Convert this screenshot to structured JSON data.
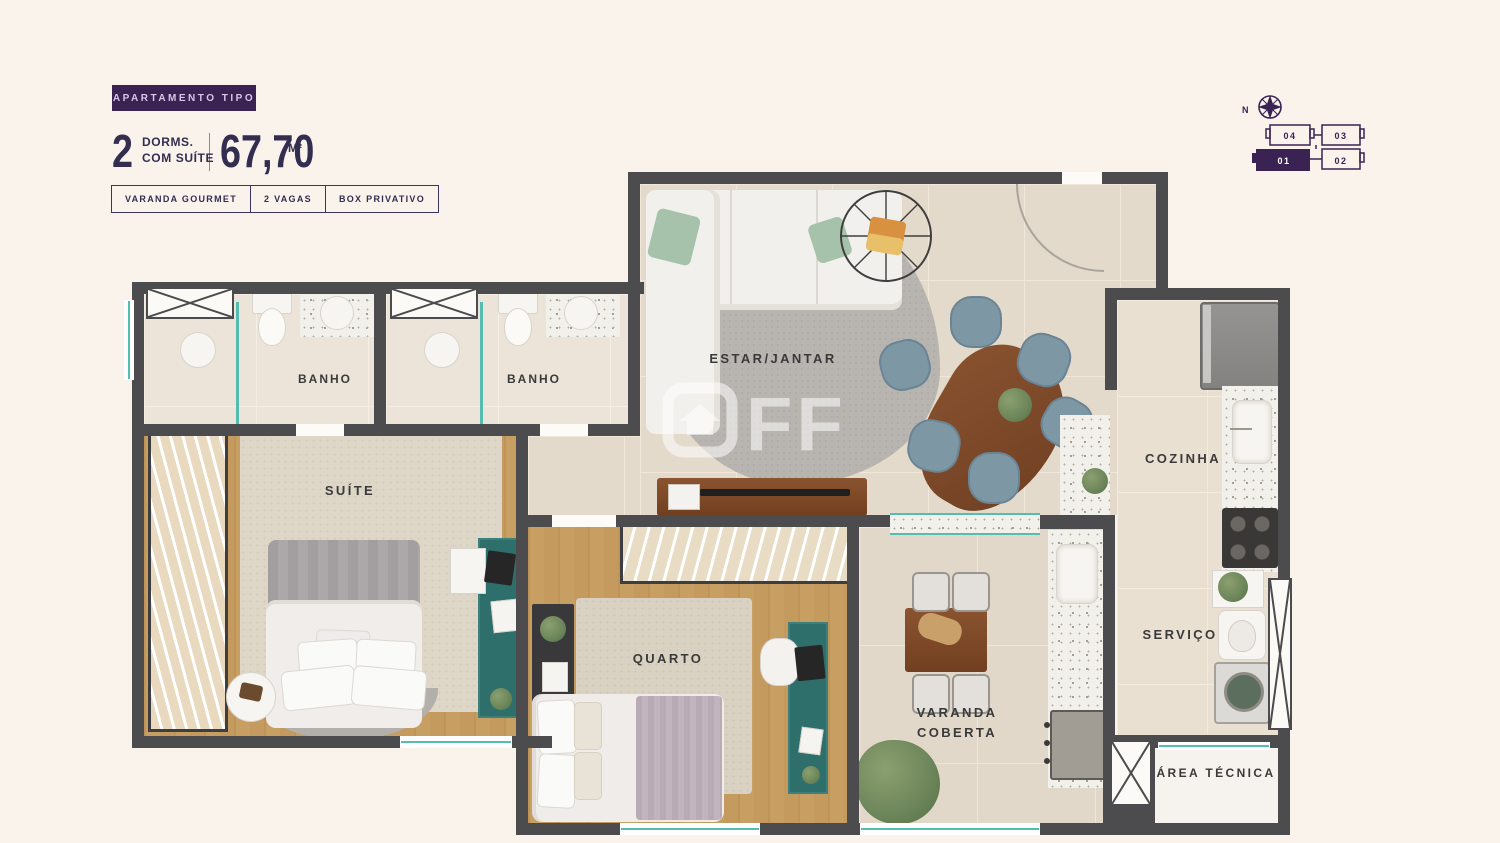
{
  "header": {
    "badge": "APARTAMENTO TIPO",
    "dorms_number": "2",
    "dorms_line1": "DORMS.",
    "dorms_line2": "COM SUÍTE",
    "area_value": "67,70",
    "area_unit": "M²",
    "tags": [
      "VARANDA GOURMET",
      "2 VAGAS",
      "BOX PRIVATIVO"
    ]
  },
  "keyplan": {
    "north_label": "N",
    "units": [
      {
        "number": "04",
        "highlighted": false
      },
      {
        "number": "03",
        "highlighted": false
      },
      {
        "number": "01",
        "highlighted": true
      },
      {
        "number": "02",
        "highlighted": false
      }
    ]
  },
  "rooms": {
    "estar_jantar": "ESTAR/JANTAR",
    "banho_suite": "BANHO",
    "banho_social": "BANHO",
    "suite": "SUÍTE",
    "quarto": "QUARTO",
    "cozinha": "COZINHA",
    "servico": "SERVIÇO",
    "varanda_coberta": "VARANDA COBERTA",
    "area_tecnica": "ÁREA TÉCNICA"
  },
  "watermark": {
    "text": "OFF",
    "ff": "FF"
  },
  "colors": {
    "brand_purple": "#3A2353",
    "title_navy": "#332D50",
    "teal_accent": "#54BDB2",
    "wall_gray": "#4C4B4D",
    "background_cream": "#FAF3EC"
  }
}
